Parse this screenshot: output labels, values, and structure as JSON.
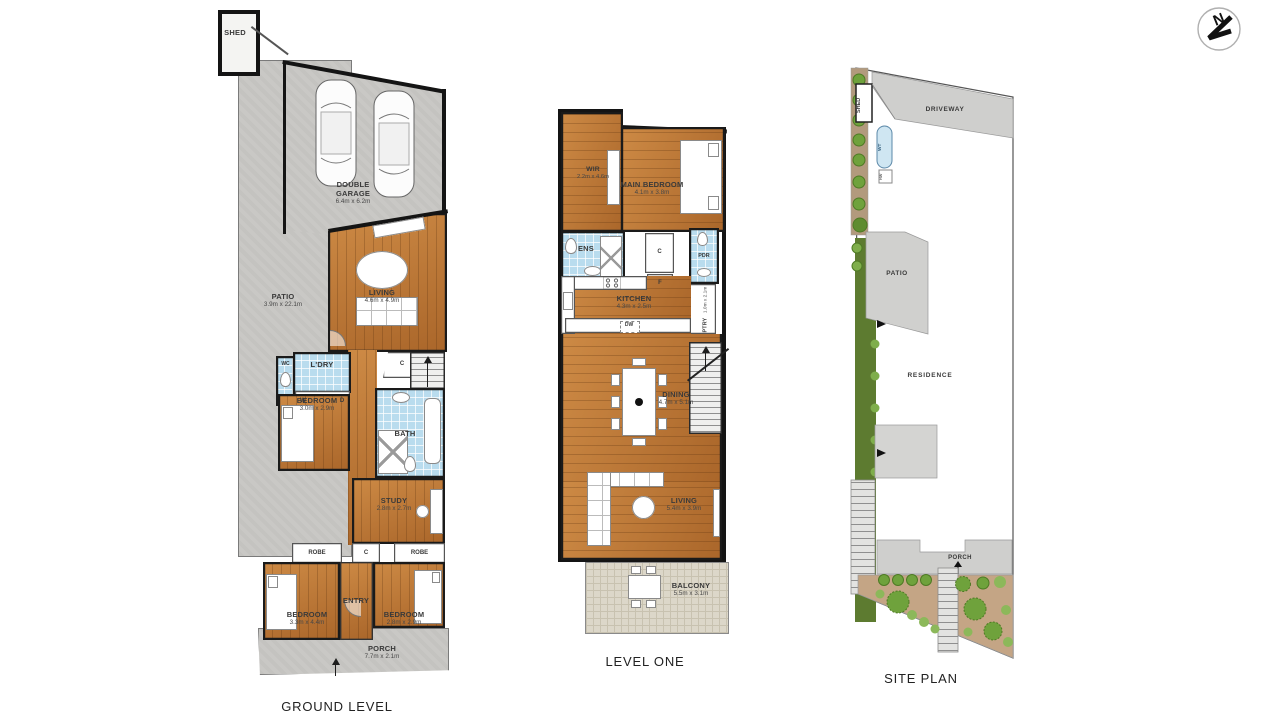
{
  "compass": {
    "north_label": "N"
  },
  "ground_level": {
    "title": "GROUND LEVEL",
    "rooms": {
      "shed": {
        "name": "SHED"
      },
      "garage": {
        "name": "DOUBLE GARAGE",
        "dims": "6.4m x 6.2m"
      },
      "patio": {
        "name": "PATIO",
        "dims": "3.9m x 22.1m"
      },
      "living": {
        "name": "LIVING",
        "dims": "4.6m x 4.9m"
      },
      "laundry": {
        "name": "L'DRY"
      },
      "wc": {
        "name": "WC"
      },
      "washer": {
        "name": "W"
      },
      "dryer": {
        "name": "D"
      },
      "bedroom_mid": {
        "name": "BEDROOM",
        "dims": "3.0m x 2.9m"
      },
      "bath": {
        "name": "BATH"
      },
      "cupboard_hall": {
        "name": "C"
      },
      "study": {
        "name": "STUDY",
        "dims": "2.8m x 2.7m"
      },
      "robe_left": {
        "name": "ROBE"
      },
      "cupboard_entry": {
        "name": "C"
      },
      "robe_right": {
        "name": "ROBE"
      },
      "bedroom_left": {
        "name": "BEDROOM",
        "dims": "3.3m x 4.4m"
      },
      "entry": {
        "name": "ENTRY"
      },
      "bedroom_right": {
        "name": "BEDROOM",
        "dims": "2.8m x 2.9m"
      },
      "porch": {
        "name": "PORCH",
        "dims": "7.7m x 2.1m"
      }
    }
  },
  "level_one": {
    "title": "LEVEL ONE",
    "rooms": {
      "wir": {
        "name": "WIR",
        "dims": "2.2m x 4.6m"
      },
      "main_bedroom": {
        "name": "MAIN BEDROOM",
        "dims": "4.1m x 3.8m"
      },
      "ensuite": {
        "name": "ENS"
      },
      "cupboard": {
        "name": "C"
      },
      "powder": {
        "name": "PDR"
      },
      "fridge": {
        "name": "F"
      },
      "kitchen": {
        "name": "KITCHEN",
        "dims": "4.3m x 2.5m"
      },
      "dishwasher": {
        "name": "DW"
      },
      "pantry": {
        "name": "PTRY",
        "dims": "1.0m x 2.1m"
      },
      "dining": {
        "name": "DINING",
        "dims": "4.7m x 5.1m"
      },
      "living": {
        "name": "LIVING",
        "dims": "5.4m x 3.9m"
      },
      "balcony": {
        "name": "BALCONY",
        "dims": "5.5m x 3.1m"
      }
    }
  },
  "site_plan": {
    "title": "SITE PLAN",
    "labels": {
      "shed": "SHED",
      "driveway": "DRIVEWAY",
      "water_tank": "WT",
      "hot_water": "HW",
      "patio": "PATIO",
      "residence": "RESIDENCE",
      "porch": "PORCH"
    }
  },
  "colors": {
    "wall": "#141414",
    "wood_floor": "#bd7a38",
    "concrete": "#c9c8c5",
    "wet_area_tile": "#b9dcee",
    "balcony_tile": "#dcd7c9",
    "site_lawn_strip": "#5d7b30",
    "site_garden_bed": "#c4a585",
    "site_shrub": "#6fa23c"
  }
}
